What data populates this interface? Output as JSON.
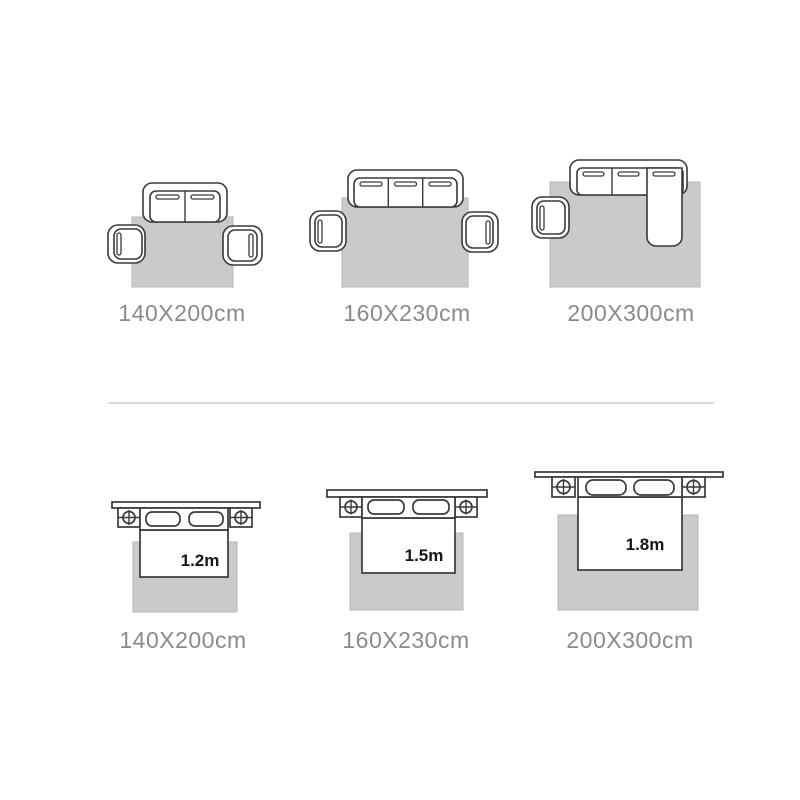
{
  "colors": {
    "background": "#ffffff",
    "outline": "#3a3a3a",
    "rug_fill": "#cacaca",
    "rug_stroke": "#b5b5b5",
    "size_label_text": "#8a8a8a",
    "bed_width_text": "#161616",
    "divider": "#d8d8d8"
  },
  "sofa_row": {
    "items": [
      {
        "size_label": "140X200cm",
        "icon": "two-seat-sofa-two-armchairs-rug-icon"
      },
      {
        "size_label": "160X230cm",
        "icon": "three-seat-sofa-two-armchairs-rug-icon"
      },
      {
        "size_label": "200X300cm",
        "icon": "corner-sofa-armchair-rug-icon"
      }
    ]
  },
  "bed_row": {
    "items": [
      {
        "size_label": "140X200cm",
        "bed_width": "1.2m",
        "icon": "double-bed-nightstands-rug-icon"
      },
      {
        "size_label": "160X230cm",
        "bed_width": "1.5m",
        "icon": "double-bed-nightstands-rug-icon"
      },
      {
        "size_label": "200X300cm",
        "bed_width": "1.8m",
        "icon": "double-bed-nightstands-rug-icon"
      }
    ]
  }
}
